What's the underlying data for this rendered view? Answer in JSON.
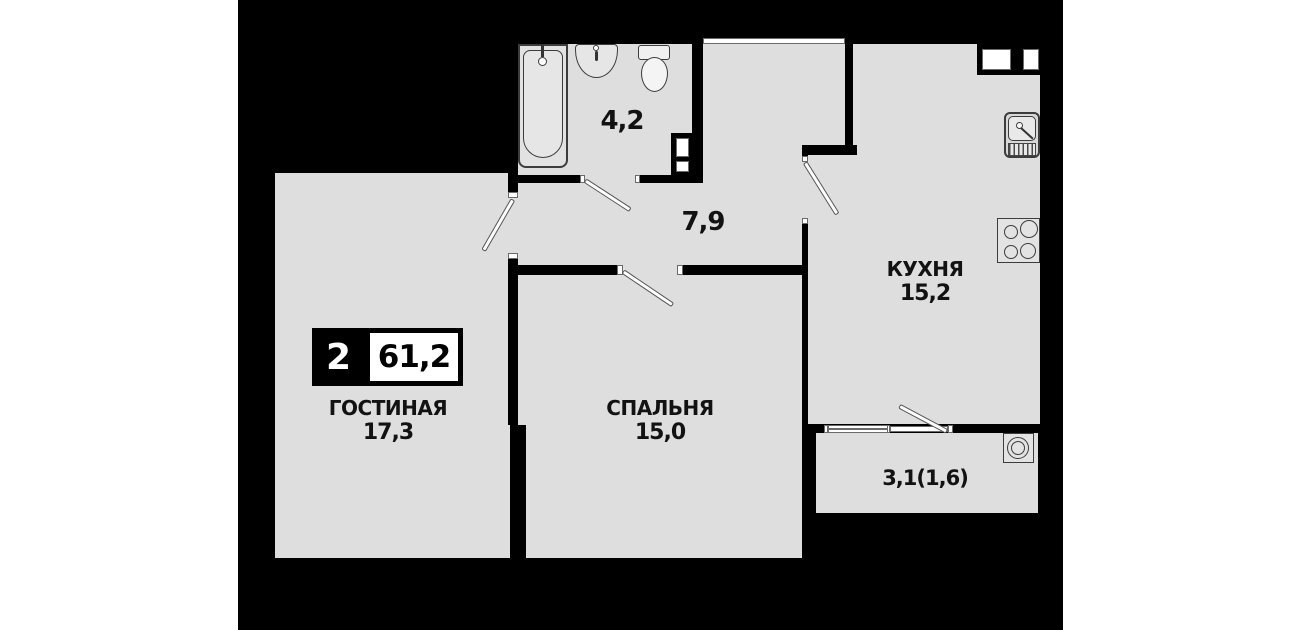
{
  "plan": {
    "badge": {
      "rooms_count": "2",
      "total_area": "61,2"
    },
    "rooms": {
      "living": {
        "name": "ГОСТИНАЯ",
        "area": "17,3"
      },
      "bedroom": {
        "name": "СПАЛЬНЯ",
        "area": "15,0"
      },
      "kitchen": {
        "name": "КУХНЯ",
        "area": "15,2"
      },
      "bathroom": {
        "area": "4,2"
      },
      "hallway": {
        "area": "7,9"
      },
      "loggia": {
        "area": "3,1(1,6)"
      }
    },
    "fixtures": [
      "bathtub",
      "bath-sink",
      "toilet",
      "vent-duct",
      "kitchen-vent-shaft",
      "kitchen-sink",
      "stove",
      "washer"
    ],
    "colors": {
      "page_background": "#ffffff",
      "plan_background": "#000000",
      "room_fill": "#dedede",
      "wall": "#000000",
      "text": "#121212",
      "door_leaf": "#ffffff"
    }
  }
}
